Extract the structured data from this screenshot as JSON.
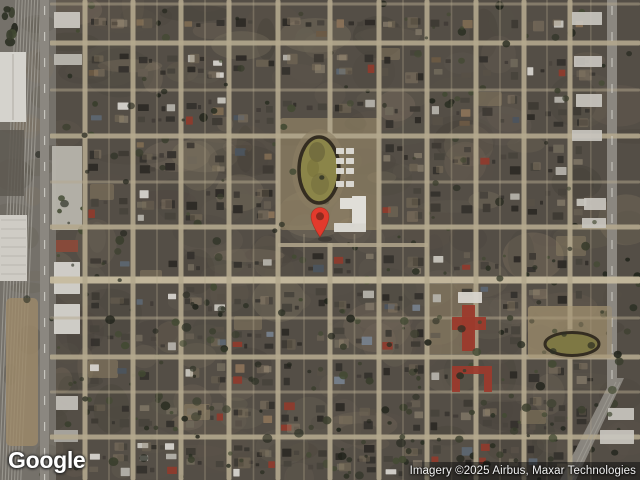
{
  "branding": {
    "logo_text": "Google"
  },
  "attribution": {
    "text": "Imagery ©2025 Airbus, Maxar Technologies"
  },
  "map": {
    "view_type": "satellite",
    "size": {
      "width": 640,
      "height": 480
    },
    "marker": {
      "x": 320,
      "y": 238,
      "color": "#E23A2C",
      "dot_color": "#8E2A1E"
    },
    "palette": {
      "ground": "#544e46",
      "ground_tones": [
        "#6a6256",
        "#4a453e",
        "#5f584c",
        "#746a5a",
        "#3f3b34",
        "#867966",
        "#5a5349"
      ],
      "street": "#b3a78d",
      "street_major": "#c6ba9f",
      "house_dark": [
        "#35322d",
        "#3e3a34",
        "#48433c",
        "#2d2a26"
      ],
      "house_mid": [
        "#575047",
        "#655d51",
        "#6f675a",
        "#7b7263"
      ],
      "roof_light": [
        "#c7c4bd",
        "#d6d3cd",
        "#b4b1aa"
      ],
      "roof_slate": [
        "#5d6671",
        "#76808c",
        "#4c545e"
      ],
      "roof_warm": [
        "#7d6a52",
        "#8a7258",
        "#6b5a44"
      ],
      "red_roof_alt": "#8e3b2d",
      "yard_tones": [
        "#97876b",
        "#a8957a",
        "#81745e"
      ],
      "tree_tones": [
        "#2c3024",
        "#3a3e2d",
        "#22251c",
        "#434a33"
      ],
      "tan_lot": "#a2916f",
      "rail_base": "#75716a",
      "rail_line": "#a8a59d",
      "road": "#8b8780",
      "road_dash": "#dad8d2",
      "building_light": "#d5d3cd",
      "track_field": "#8b8549",
      "track_ring": "#342d21",
      "track_dirt": "#8a7d63",
      "red_roof": "#9c3a2c"
    },
    "streets": {
      "horizontal_y": [
        4,
        43,
        90,
        136,
        182,
        227,
        280,
        318,
        357,
        392,
        437
      ],
      "horizontal_minor_y": [
        4,
        90,
        182,
        318,
        392
      ],
      "major_horizontal_y": 280,
      "segment_street": {
        "y": 245,
        "x1": 278,
        "x2": 428
      },
      "vertical_x": [
        85,
        133,
        181,
        229,
        278,
        330,
        379,
        427,
        476,
        524,
        570
      ],
      "campus_gap_street_x": 330,
      "west_road_x": 44,
      "east_road_x": 612
    },
    "landmarks": {
      "running_track": {
        "cx": 319,
        "cy": 170,
        "rx": 20,
        "ry": 33
      },
      "east_track": {
        "cx": 572,
        "cy": 344,
        "rx": 27,
        "ry": 11.5
      },
      "campus_block": {
        "x": 280,
        "y": 118,
        "w": 100,
        "h": 112
      },
      "east_park": {
        "x": 528,
        "y": 306,
        "w": 84,
        "h": 52
      },
      "red_school": {
        "x": 452,
        "y": 296,
        "w": 40,
        "h": 96
      },
      "rail_yard": {
        "x": 0,
        "y": 0,
        "w": 56,
        "h": 480
      }
    }
  }
}
